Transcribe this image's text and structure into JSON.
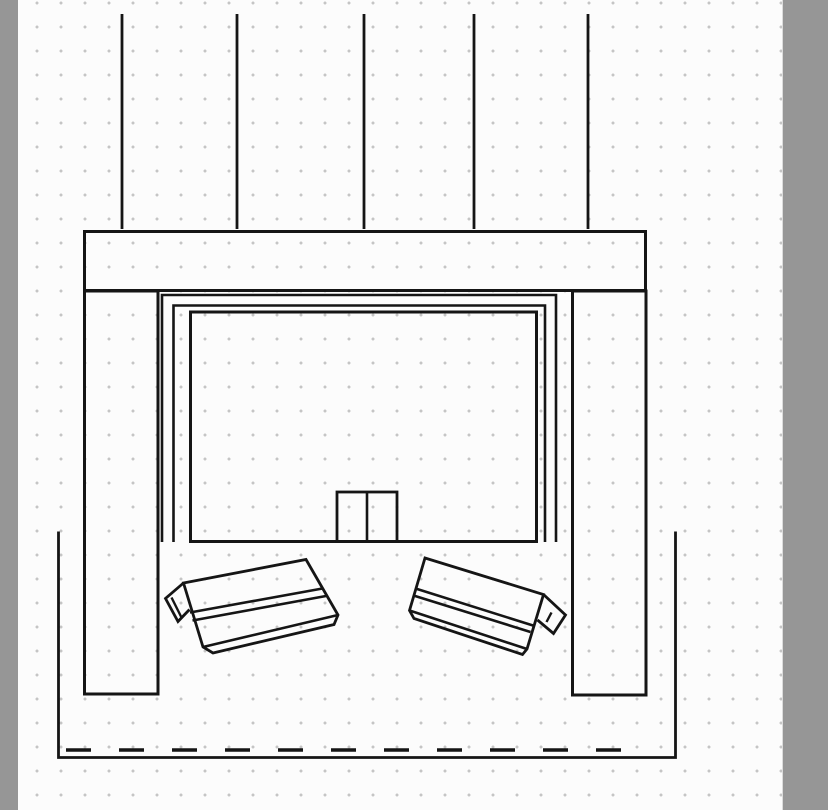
{
  "workspace": {
    "pasteboard_color": "#969696",
    "canvas_color": "#fcfcfc",
    "grid": {
      "spacing": 24,
      "dot_color": "#c5c5c5",
      "dot_radius": 1.3,
      "offset_x": 7,
      "offset_y": 15
    }
  },
  "drawing": {
    "stroke_color": "#151515",
    "shapes": [
      {
        "name": "ceiling-line-1",
        "type": "line",
        "x1": 122,
        "y1": 14,
        "x2": 122,
        "y2": 229,
        "sw": 2.8
      },
      {
        "name": "ceiling-line-2",
        "type": "line",
        "x1": 237,
        "y1": 14,
        "x2": 237,
        "y2": 229,
        "sw": 2.8
      },
      {
        "name": "ceiling-line-3",
        "type": "line",
        "x1": 364,
        "y1": 14,
        "x2": 364,
        "y2": 229,
        "sw": 2.8
      },
      {
        "name": "ceiling-line-4",
        "type": "line",
        "x1": 474,
        "y1": 14,
        "x2": 474,
        "y2": 229,
        "sw": 2.8
      },
      {
        "name": "ceiling-line-5",
        "type": "line",
        "x1": 588,
        "y1": 14,
        "x2": 588,
        "y2": 229,
        "sw": 2.8
      },
      {
        "name": "header-beam",
        "type": "rect",
        "x": 84.5,
        "y": 231.5,
        "w": 561,
        "h": 59,
        "sw": 3
      },
      {
        "name": "left-column",
        "type": "rect",
        "x": 84.5,
        "y": 291,
        "w": 73.5,
        "h": 403,
        "sw": 3
      },
      {
        "name": "right-column",
        "type": "rect",
        "x": 572.5,
        "y": 291,
        "w": 73.5,
        "h": 404,
        "sw": 3
      },
      {
        "name": "screen-housing-outer",
        "type": "path",
        "d": "M162,542 L162,295 L556,295 L556,542",
        "sw": 2.6
      },
      {
        "name": "screen-housing-inner",
        "type": "path",
        "d": "M173.5,542 L173.5,305.5 L545,305.5 L545,542",
        "sw": 2.6
      },
      {
        "name": "screen-panel",
        "type": "rect",
        "x": 190.5,
        "y": 312,
        "w": 346,
        "h": 229.5,
        "sw": 3
      },
      {
        "name": "center-box",
        "type": "rect",
        "x": 337,
        "y": 492,
        "w": 60,
        "h": 49.5,
        "sw": 2.8
      },
      {
        "name": "center-box-divider",
        "type": "line",
        "x1": 367,
        "y1": 492,
        "x2": 367,
        "y2": 541.5,
        "sw": 2.6
      },
      {
        "name": "left-wedge-outline",
        "type": "path",
        "d": "M183.5,583 L306,559.5 L338,615 L334,624.5 L213,653 L203,647 Z",
        "sw": 2.8
      },
      {
        "name": "left-wedge-divider-a",
        "type": "path",
        "d": "M190,612.5 L322.5,588.5",
        "sw": 2.6
      },
      {
        "name": "left-wedge-divider-b",
        "type": "path",
        "d": "M192.5,620.5 L326,596",
        "sw": 2.6
      },
      {
        "name": "left-wedge-lip",
        "type": "path",
        "d": "M203,647 L338,615",
        "sw": 2.6
      },
      {
        "name": "left-wedge-flap",
        "type": "path",
        "d": "M183.5,583 L165.5,598.5 L178,621.5 L189.5,609.5",
        "sw": 2.8
      },
      {
        "name": "left-wedge-flap-inner",
        "type": "path",
        "d": "M171.5,597.5 L182,618.5",
        "sw": 2.4
      },
      {
        "name": "right-wedge-outline",
        "type": "path",
        "d": "M425,558 L543.5,594.5 L527,649 L522.5,654.5 L414,618.5 L409.5,610.5 Z",
        "sw": 2.8
      },
      {
        "name": "right-wedge-divider-a",
        "type": "path",
        "d": "M415.5,588.5 L533,625.5",
        "sw": 2.6
      },
      {
        "name": "right-wedge-divider-b",
        "type": "path",
        "d": "M413.5,595.5 L530.5,632",
        "sw": 2.6
      },
      {
        "name": "right-wedge-lip",
        "type": "path",
        "d": "M409.5,610.5 L527,649",
        "sw": 2.6
      },
      {
        "name": "right-wedge-flap",
        "type": "path",
        "d": "M543.5,594.5 L565.5,615 L553.5,633.5 L537.5,620",
        "sw": 2.8
      },
      {
        "name": "right-wedge-flap-inner",
        "type": "path",
        "d": "M551.5,612.5 L546.5,622",
        "sw": 2.4
      },
      {
        "name": "pit-outline",
        "type": "path",
        "d": "M58.5,531.5 L58.5,757.5 L675.5,757.5 L675.5,531.5",
        "sw": 2.8
      },
      {
        "name": "pit-dashed-line",
        "type": "line",
        "x1": 66,
        "y1": 750,
        "x2": 647,
        "y2": 750,
        "sw": 3.4,
        "dash": "25 28"
      }
    ]
  }
}
